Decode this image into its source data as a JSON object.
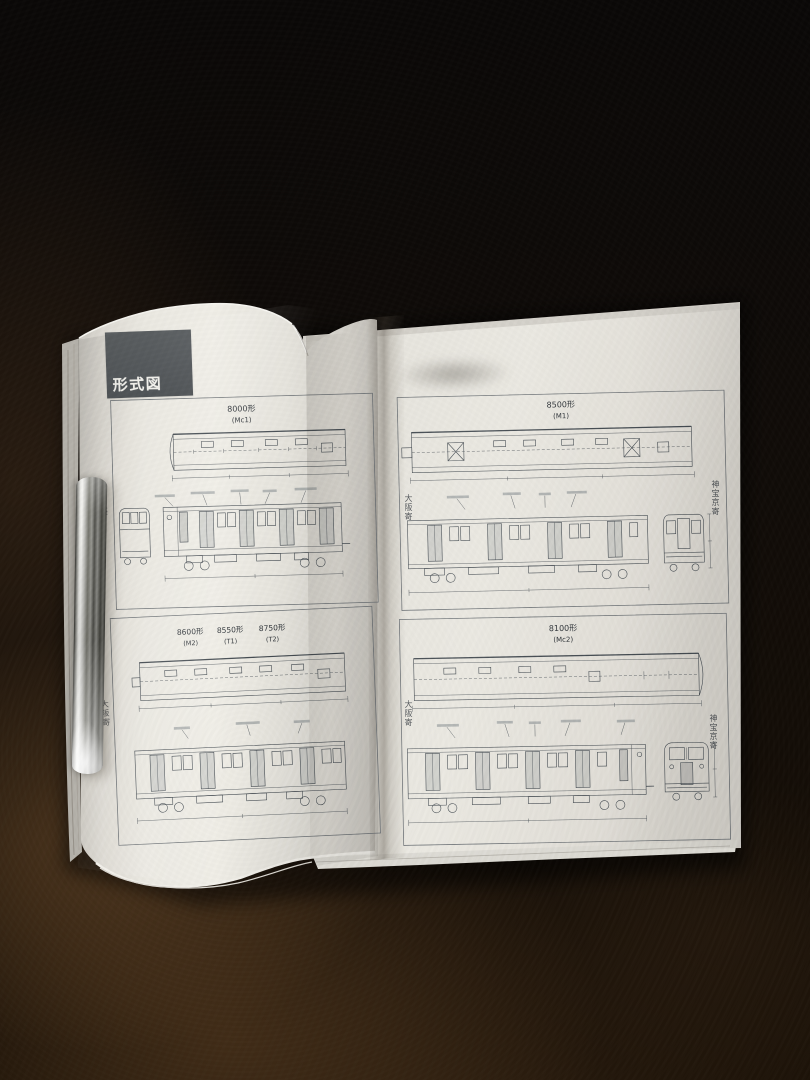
{
  "section": {
    "label": "形式図"
  },
  "pages": {
    "left": {
      "panels": [
        {
          "cars": [
            {
              "model": "8000形",
              "class": "(Mc1)"
            }
          ],
          "side_label_left": "大阪寄"
        },
        {
          "cars": [
            {
              "model": "8600形",
              "class": "(M2)"
            },
            {
              "model": "8550形",
              "class": "(T1)"
            },
            {
              "model": "8750形",
              "class": "(T2)"
            }
          ],
          "side_label_left": "大阪寄"
        }
      ]
    },
    "right": {
      "panels": [
        {
          "cars": [
            {
              "model": "8500形",
              "class": "(M1)"
            }
          ],
          "side_label_left": "大阪寄",
          "side_label_right": "神宝京寄"
        },
        {
          "cars": [
            {
              "model": "8100形",
              "class": "(Mc2)"
            }
          ],
          "side_label_left": "大阪寄",
          "side_label_right": "神宝京寄"
        }
      ]
    }
  },
  "colors": {
    "table_dark": "#0f0b08",
    "table_warm": "#6b4a2a",
    "paper": "#e9e7e0",
    "paper_edge": "#c9c6bf",
    "section_box": "#54585b",
    "section_text": "#f2f1ec",
    "drawing_line": "#454c52",
    "chrome_highlight": "#f4f4f1",
    "chrome_shadow": "#45453f"
  }
}
